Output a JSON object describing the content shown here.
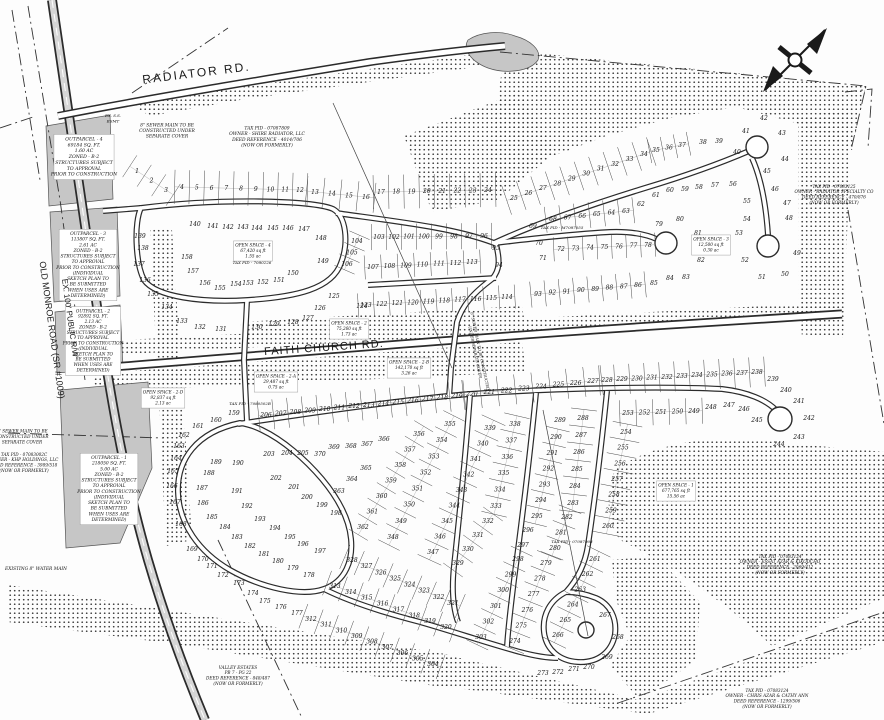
{
  "title": "Subdivision Sketch Plan",
  "road_labels": {
    "radiator": "RADIATOR RD.",
    "faith_church": "FAITH CHURCH RD.",
    "old_monroe_line1": "OLD MONROE ROAD (SR #1009)",
    "old_monroe_line2": "EX. 100' PUBLIC R/W"
  },
  "colors": {
    "paper": "#fdfdfd",
    "line": "#2b2b2b",
    "parcel_gray": "#c6c6c6"
  },
  "annotations": [
    {
      "id": "outparcel-4",
      "x": 84,
      "y": 158,
      "fs": 4.6,
      "rot": 0,
      "box": true,
      "lines": [
        "OUTPARCEL - 4",
        "69184 SQ. FT.",
        "1.60 AC",
        "ZONED - B-2",
        "STRUCTURES SUBJECT",
        "TO APPROVAL",
        "PRIOR TO CONSTRUCTION"
      ]
    },
    {
      "id": "sewer-note-top",
      "x": 167,
      "y": 132,
      "fs": 4.4,
      "rot": 0,
      "box": false,
      "lines": [
        "8\" SEWER MAIN TO BE",
        "CONSTRUCTED UNDER",
        "SEPARATE COVER"
      ]
    },
    {
      "id": "tax-pid-shire",
      "x": 267,
      "y": 138,
      "fs": 4.4,
      "rot": 0,
      "box": false,
      "lines": [
        "TAX PID - 07087809",
        "OWNER - SHIRE RADIATOR, LLC",
        "DEED REFERENCE - 4014/706",
        "(NOW OR FORMERLY)"
      ]
    },
    {
      "id": "outparcel-3",
      "x": 88,
      "y": 266,
      "fs": 4.4,
      "rot": 0,
      "box": true,
      "lines": [
        "OUTPARCEL - 3",
        "113807 SQ. FT.",
        "2.61 AC",
        "ZONED - B-2",
        "STRUCTURES SUBJECT",
        "TO APPROVAL",
        "PRIOR TO CONSTRUCTION",
        "(INDIVIDUAL",
        "SKETCH PLAN TO",
        "BE SUBMITTED",
        "WHEN USES ARE",
        "DETERMINED)"
      ]
    },
    {
      "id": "outparcel-2",
      "x": 93,
      "y": 342,
      "fs": 4.2,
      "rot": 0,
      "box": true,
      "lines": [
        "OUTPARCEL - 2",
        "92892 SQ. FT.",
        "2.13 AC",
        "ZONED - B-2",
        "STRUCTURES SUBJECT",
        "TO APPROVAL",
        "PRIOR TO CONSTRUCTION",
        "(INDIVIDUAL",
        "SKETCH PLAN TO",
        "BE SUBMITTED",
        "WHEN USES ARE",
        "DETERMINED)"
      ]
    },
    {
      "id": "outparcel-1",
      "x": 109,
      "y": 490,
      "fs": 4.4,
      "rot": 0,
      "box": true,
      "lines": [
        "OUTPARCEL - 1",
        "218050 SQ. FT.",
        "5.00 AC",
        "ZONED - B-2",
        "STRUCTURES SUBJECT",
        "TO APPROVAL",
        "PRIOR TO CONSTRUCTION",
        "(INDIVIDUAL",
        "SKETCH PLAN TO",
        "BE SUBMITTED",
        "WHEN USES ARE",
        "DETERMINED)"
      ]
    },
    {
      "id": "sewer-note-left",
      "x": 22,
      "y": 438,
      "fs": 4.2,
      "rot": 0,
      "box": false,
      "lines": [
        "8\" SEWER MAIN TO BE",
        "CONSTRUCTED UNDER",
        "SEPARATE COVER"
      ]
    },
    {
      "id": "tax-pid-khp",
      "x": 24,
      "y": 464,
      "fs": 4.2,
      "rot": 0,
      "box": false,
      "lines": [
        "TAX PID - 07083002C",
        "OWNER - KHP HOLDINGS, LLC",
        "DEED REFERENCE - 3989/518",
        "(NOW OR FORMERLY)"
      ]
    },
    {
      "id": "existing-water-main",
      "x": 36,
      "y": 570,
      "fs": 4.4,
      "rot": 0,
      "box": false,
      "lines": [
        "EXISTING 8\" WATER MAIN"
      ]
    },
    {
      "id": "tax-pid-radiator-specialty",
      "x": 834,
      "y": 196,
      "fs": 4.2,
      "rot": 0,
      "box": false,
      "lines": [
        "TAX PID - 07083125",
        "OWNER - RADIATOR SPECIALTY CO",
        "DEED REFERENCE - 470/876",
        "(NOW OR FORMERLY)"
      ]
    },
    {
      "id": "tax-pid-essat",
      "x": 780,
      "y": 566,
      "fs": 4.2,
      "rot": 0,
      "box": false,
      "lines": [
        "TAX PID - 07083124",
        "OWNER - ESSAT AZAR & KIKODCHO",
        "DEED REFERENCE - 2069/412",
        "(NOW OR FORMERLY)"
      ]
    },
    {
      "id": "tax-pid-chris",
      "x": 767,
      "y": 700,
      "fs": 4.2,
      "rot": 0,
      "box": false,
      "lines": [
        "TAX PID - 07083124",
        "OWNER - CHRIS AZAR & CATHY ANN",
        "DEED REFERENCE - 1299/506",
        "(NOW OR FORMERLY)"
      ]
    },
    {
      "id": "valley-estates",
      "x": 238,
      "y": 677,
      "fs": 4.2,
      "rot": 0,
      "box": false,
      "lines": [
        "VALLEY ESTATES",
        "PB 7 - PG 22",
        "DEED REFERENCE - 848/487",
        "(NOW OR FORMERLY)"
      ]
    },
    {
      "id": "esmt-note",
      "x": 113,
      "y": 120,
      "fs": 4,
      "rot": 0,
      "box": false,
      "lines": [
        "EX. S.S.",
        "ESMT"
      ]
    },
    {
      "id": "tax-pid-small-1",
      "x": 562,
      "y": 229,
      "fs": 4,
      "rot": 0,
      "box": false,
      "lines": [
        "TAX PID - M7087055"
      ]
    },
    {
      "id": "tax-pid-small-2",
      "x": 252,
      "y": 264,
      "fs": 4,
      "rot": 0,
      "box": false,
      "lines": [
        "TAX PID - 7080226"
      ]
    },
    {
      "id": "tax-pid-small-3",
      "x": 250,
      "y": 405,
      "fs": 4,
      "rot": 0,
      "box": false,
      "lines": [
        "TAX PID - 7080502B"
      ]
    },
    {
      "id": "tax-pid-small-4",
      "x": 572,
      "y": 543,
      "fs": 4,
      "rot": 0,
      "box": false,
      "lines": [
        "TAX PID - 07087908"
      ]
    },
    {
      "id": "sewer-diag-note",
      "x": 476,
      "y": 352,
      "fs": 3.8,
      "rot": 78,
      "box": false,
      "lines": [
        "8\" SEWER MAIN TO BE CONSTRUCTED",
        "UNDER SEPARATE COVER"
      ]
    }
  ],
  "open_spaces": [
    {
      "id": "open-space-4",
      "x": 253,
      "y": 252,
      "fs": 4.2,
      "rot": 0,
      "box": true,
      "lines": [
        "OPEN SPACE - 4",
        "67,420 sq ft",
        "1.55 ac"
      ]
    },
    {
      "id": "open-space-2",
      "x": 349,
      "y": 330,
      "fs": 4.2,
      "rot": 0,
      "box": true,
      "lines": [
        "OPEN SPACE - 2",
        "75,260 sq ft",
        "1.73 ac"
      ]
    },
    {
      "id": "open-space-2b",
      "x": 409,
      "y": 369,
      "fs": 4.2,
      "rot": 0,
      "box": true,
      "lines": [
        "OPEN SPACE - 2-B",
        "142,170 sq ft",
        "3.26 ac"
      ]
    },
    {
      "id": "open-space-2a",
      "x": 276,
      "y": 383,
      "fs": 4.2,
      "rot": 0,
      "box": true,
      "lines": [
        "OPEN SPACE - 2-A",
        "29,487 sq ft",
        "0.75 ac"
      ]
    },
    {
      "id": "open-space-2d",
      "x": 163,
      "y": 399,
      "fs": 4.2,
      "rot": 0,
      "box": true,
      "lines": [
        "OPEN SPACE - 2-D",
        "92,837 sq ft",
        "2.13 ac"
      ]
    },
    {
      "id": "open-space-3",
      "x": 711,
      "y": 246,
      "fs": 4.2,
      "rot": 0,
      "box": true,
      "lines": [
        "OPEN SPACE - 3",
        "12,500 sq ft",
        "0.30 ac"
      ]
    },
    {
      "id": "open-space-1",
      "x": 676,
      "y": 492,
      "fs": 4.2,
      "rot": 0,
      "box": true,
      "lines": [
        "OPEN SPACE - 1",
        "677,765 sq ft",
        "15.56 ac"
      ]
    }
  ],
  "lots": {
    "rows": [
      [
        1,
        3,
        137,
        171,
        166,
        190,
        26
      ],
      [
        4,
        12,
        182,
        187,
        300,
        190,
        34
      ],
      [
        13,
        16,
        315,
        192,
        366,
        197,
        30
      ],
      [
        17,
        24,
        381,
        192,
        488,
        190,
        34
      ],
      [
        25,
        34,
        514,
        198,
        644,
        154,
        30
      ],
      [
        35,
        37,
        656,
        150,
        682,
        145,
        24
      ],
      [
        63,
        68,
        626,
        211,
        553,
        219,
        26
      ],
      [
        72,
        78,
        561,
        249,
        648,
        245,
        24
      ],
      [
        86,
        93,
        638,
        285,
        538,
        294,
        26
      ],
      [
        96,
        103,
        484,
        236,
        379,
        237,
        26
      ],
      [
        104,
        106,
        357,
        241,
        347,
        264,
        22
      ],
      [
        107,
        113,
        373,
        267,
        472,
        262,
        24
      ],
      [
        114,
        123,
        507,
        297,
        366,
        305,
        24
      ],
      [
        206,
        219,
        266,
        415,
        457,
        396,
        30
      ],
      [
        220,
        227,
        472,
        394,
        593,
        381,
        30
      ],
      [
        228,
        238,
        607,
        380,
        757,
        372,
        30
      ],
      [
        249,
        253,
        694,
        411,
        628,
        413,
        26
      ],
      [
        254,
        260,
        626,
        432,
        608,
        526,
        30
      ],
      [
        261,
        266,
        595,
        559,
        558,
        635,
        26
      ],
      [
        274,
        279,
        515,
        641,
        546,
        563,
        26
      ],
      [
        280,
        282,
        555,
        548,
        567,
        517,
        24
      ],
      [
        283,
        288,
        573,
        503,
        583,
        418,
        26
      ],
      [
        290,
        295,
        556,
        437,
        537,
        516,
        24
      ],
      [
        298,
        303,
        518,
        559,
        481,
        637,
        24
      ],
      [
        304,
        312,
        433,
        664,
        311,
        619,
        26
      ],
      [
        313,
        320,
        335,
        586,
        446,
        627,
        26
      ],
      [
        321,
        328,
        453,
        603,
        352,
        560,
        26
      ],
      [
        329,
        332,
        458,
        563,
        488,
        521,
        24
      ],
      [
        333,
        338,
        496,
        506,
        515,
        424,
        26
      ],
      [
        339,
        347,
        490,
        428,
        433,
        552,
        26
      ],
      [
        348,
        355,
        393,
        537,
        450,
        424,
        24
      ],
      [
        356,
        362,
        419,
        434,
        363,
        527,
        22
      ]
    ],
    "points": [
      [
        38,
        703,
        142
      ],
      [
        39,
        719,
        141
      ],
      [
        40,
        737,
        152
      ],
      [
        41,
        746,
        131
      ],
      [
        42,
        764,
        118
      ],
      [
        43,
        782,
        133
      ],
      [
        44,
        785,
        159
      ],
      [
        45,
        767,
        171
      ],
      [
        46,
        775,
        189
      ],
      [
        47,
        787,
        203
      ],
      [
        48,
        789,
        218
      ],
      [
        49,
        797,
        253
      ],
      [
        50,
        785,
        274
      ],
      [
        51,
        762,
        277
      ],
      [
        52,
        745,
        260
      ],
      [
        53,
        739,
        233
      ],
      [
        54,
        747,
        219
      ],
      [
        55,
        747,
        201
      ],
      [
        56,
        733,
        184
      ],
      [
        57,
        715,
        185
      ],
      [
        58,
        699,
        187
      ],
      [
        59,
        685,
        189
      ],
      [
        60,
        670,
        190
      ],
      [
        61,
        656,
        195
      ],
      [
        62,
        641,
        204
      ],
      [
        69,
        533,
        226
      ],
      [
        70,
        539,
        243
      ],
      [
        71,
        543,
        258
      ],
      [
        79,
        659,
        224
      ],
      [
        80,
        680,
        219
      ],
      [
        81,
        698,
        233
      ],
      [
        82,
        701,
        260
      ],
      [
        83,
        686,
        277
      ],
      [
        84,
        670,
        278
      ],
      [
        85,
        654,
        283
      ],
      [
        94,
        499,
        265
      ],
      [
        95,
        496,
        248
      ],
      [
        124,
        362,
        306
      ],
      [
        125,
        334,
        296
      ],
      [
        126,
        320,
        308
      ],
      [
        127,
        308,
        318
      ],
      [
        128,
        293,
        322
      ],
      [
        129,
        274,
        324
      ],
      [
        130,
        257,
        327
      ],
      [
        131,
        221,
        329
      ],
      [
        132,
        200,
        327
      ],
      [
        133,
        182,
        321
      ],
      [
        134,
        167,
        307
      ],
      [
        135,
        153,
        294
      ],
      [
        136,
        145,
        280
      ],
      [
        137,
        139,
        264
      ],
      [
        138,
        143,
        248
      ],
      [
        139,
        140,
        236
      ],
      [
        140,
        195,
        224
      ],
      [
        141,
        213,
        226
      ],
      [
        142,
        228,
        227
      ],
      [
        143,
        243,
        227
      ],
      [
        144,
        257,
        228
      ],
      [
        145,
        273,
        228
      ],
      [
        146,
        288,
        228
      ],
      [
        147,
        304,
        229
      ],
      [
        148,
        321,
        238
      ],
      [
        149,
        323,
        261
      ],
      [
        150,
        293,
        273
      ],
      [
        151,
        279,
        280
      ],
      [
        152,
        263,
        282
      ],
      [
        153,
        248,
        283
      ],
      [
        154,
        236,
        284
      ],
      [
        155,
        220,
        288
      ],
      [
        156,
        205,
        283
      ],
      [
        157,
        193,
        271
      ],
      [
        158,
        187,
        257
      ],
      [
        159,
        234,
        413
      ],
      [
        160,
        216,
        420
      ],
      [
        161,
        198,
        426
      ],
      [
        162,
        184,
        435
      ],
      [
        163,
        179,
        446
      ],
      [
        164,
        176,
        458
      ],
      [
        165,
        173,
        471
      ],
      [
        166,
        172,
        486
      ],
      [
        167,
        175,
        502
      ],
      [
        168,
        181,
        524
      ],
      [
        169,
        192,
        549
      ],
      [
        170,
        203,
        559
      ],
      [
        171,
        212,
        566
      ],
      [
        172,
        223,
        575
      ],
      [
        173,
        239,
        583
      ],
      [
        174,
        253,
        593
      ],
      [
        175,
        265,
        601
      ],
      [
        176,
        281,
        607
      ],
      [
        177,
        297,
        613
      ],
      [
        178,
        309,
        575
      ],
      [
        179,
        293,
        568
      ],
      [
        180,
        278,
        561
      ],
      [
        181,
        264,
        554
      ],
      [
        182,
        250,
        546
      ],
      [
        183,
        237,
        537
      ],
      [
        184,
        225,
        527
      ],
      [
        185,
        212,
        517
      ],
      [
        186,
        203,
        503
      ],
      [
        187,
        202,
        488
      ],
      [
        188,
        209,
        473
      ],
      [
        189,
        216,
        462
      ],
      [
        190,
        238,
        463
      ],
      [
        191,
        237,
        491
      ],
      [
        192,
        247,
        506
      ],
      [
        193,
        260,
        519
      ],
      [
        194,
        275,
        528
      ],
      [
        195,
        290,
        537
      ],
      [
        196,
        303,
        544
      ],
      [
        197,
        320,
        551
      ],
      [
        198,
        336,
        513
      ],
      [
        199,
        322,
        505
      ],
      [
        200,
        307,
        497
      ],
      [
        201,
        294,
        487
      ],
      [
        202,
        276,
        478
      ],
      [
        203,
        269,
        454
      ],
      [
        204,
        287,
        453
      ],
      [
        205,
        303,
        453
      ],
      [
        239,
        773,
        379
      ],
      [
        240,
        786,
        390
      ],
      [
        241,
        799,
        401
      ],
      [
        242,
        809,
        418
      ],
      [
        243,
        799,
        437
      ],
      [
        244,
        779,
        444
      ],
      [
        245,
        757,
        420
      ],
      [
        246,
        744,
        409
      ],
      [
        247,
        729,
        405
      ],
      [
        248,
        711,
        407
      ],
      [
        267,
        605,
        615
      ],
      [
        268,
        618,
        637
      ],
      [
        269,
        607,
        657
      ],
      [
        270,
        589,
        667
      ],
      [
        271,
        574,
        669
      ],
      [
        272,
        558,
        672
      ],
      [
        273,
        543,
        673
      ],
      [
        289,
        560,
        420
      ],
      [
        296,
        528,
        530
      ],
      [
        297,
        523,
        545
      ],
      [
        363,
        339,
        491
      ],
      [
        364,
        352,
        479
      ],
      [
        365,
        366,
        468
      ],
      [
        366,
        384,
        439
      ],
      [
        367,
        367,
        444
      ],
      [
        368,
        351,
        446
      ],
      [
        369,
        334,
        447
      ],
      [
        370,
        320,
        454
      ]
    ]
  }
}
